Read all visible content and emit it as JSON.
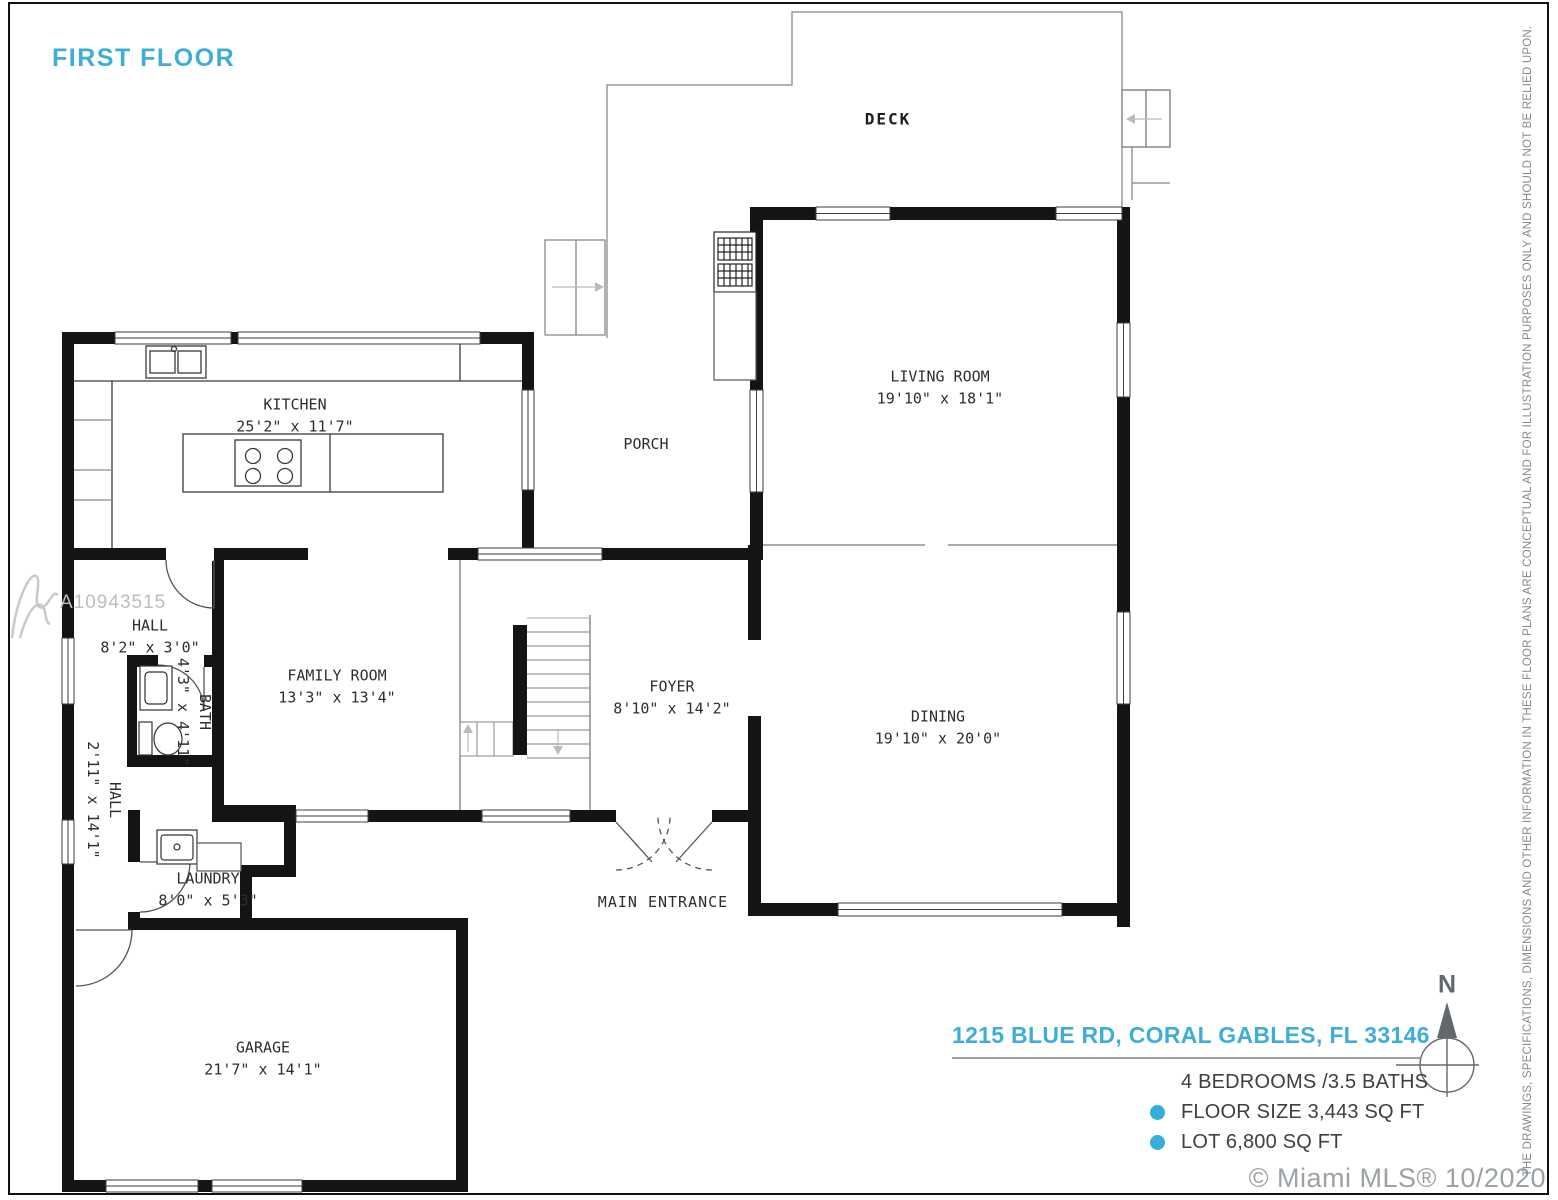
{
  "colors": {
    "accent": "#3FAED6",
    "bullet": "#35AEDC",
    "label": "#2E2E2E",
    "muted": "#9BA1A5",
    "disclaimer": "#85898C",
    "compass": "#63686C",
    "watermark": "#BDBDBD"
  },
  "header": {
    "floor_label": "FIRST FLOOR"
  },
  "rooms": {
    "deck": {
      "name": "DECK"
    },
    "kitchen": {
      "name": "KITCHEN",
      "dims": "25'2\" x 11'7\""
    },
    "porch": {
      "name": "PORCH"
    },
    "living": {
      "name": "LIVING ROOM",
      "dims": "19'10\" x 18'1\""
    },
    "hall_top": {
      "name": "HALL",
      "dims": "8'2\" x 3'0\""
    },
    "bath": {
      "name": "BATH",
      "dims": "4'3\" x 4'11\""
    },
    "family": {
      "name": "FAMILY ROOM",
      "dims": "13'3\" x 13'4\""
    },
    "foyer": {
      "name": "FOYER",
      "dims": "8'10\" x 14'2\""
    },
    "dining": {
      "name": "DINING",
      "dims": "19'10\" x 20'0\""
    },
    "hall_side": {
      "name": "HALL",
      "dims": "2'11\" x 14'1\""
    },
    "laundry": {
      "name": "LAUNDRY",
      "dims": "8'0\" x 5'3\""
    },
    "garage": {
      "name": "GARAGE",
      "dims": "21'7\" x 14'1\""
    },
    "main_entrance": {
      "name": "MAIN ENTRANCE"
    }
  },
  "info": {
    "address": "1215 BLUE RD, CORAL GABLES, FL 33146",
    "beds_baths": "4 BEDROOMS /3.5 BATHS",
    "floor_size": "FLOOR SIZE 3,443 SQ FT",
    "lot_size": "LOT 6,800 SQ FT"
  },
  "compass": {
    "north_label": "N"
  },
  "watermark": {
    "id": "A10943515"
  },
  "footer": {
    "copyright": "© Miami MLS® 10/2020"
  },
  "disclaimer": {
    "text": "THE DRAWINGS, SPECIFICATIONS, DIMENSIONS AND OTHER INFORMATION IN THESE FLOOR PLANS ARE CONCEPTUAL AND FOR ILLUSTRATION PURPOSES ONLY AND SHOULD NOT BE RELIED UPON."
  }
}
